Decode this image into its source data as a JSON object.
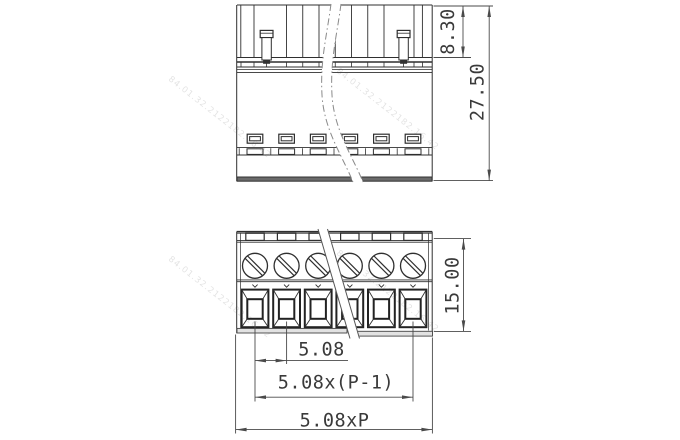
{
  "dims": {
    "d830": {
      "label": "8.30"
    },
    "d2750": {
      "label": "27.50"
    },
    "d1500": {
      "label": "15.00"
    },
    "d508": {
      "label": "5.08"
    },
    "d508p1": {
      "label": "5.08x(P-1)"
    },
    "d508p": {
      "label": "5.08xP"
    }
  },
  "watermark": {
    "text": "84.01.32.2122182.16.42"
  },
  "geometry": {
    "poles_visible": 6,
    "pole_centers_px": [
      255,
      286.6,
      318.2,
      349.8,
      381.4,
      413
    ],
    "pin_centers_px": [
      266.6,
      403.6
    ],
    "rib_xs_px": [
      254,
      286.5,
      302.75,
      319,
      335.25,
      351.5,
      367.75,
      384,
      414
    ],
    "screw_center_y_px": 265.8,
    "screw_radius_px": 12.5
  },
  "colors": {
    "line": "#2f2f2f",
    "dim": "#4a4a4a",
    "base_fill_dark": "#6a6a6a",
    "base_fill_light": "#e2e2e2",
    "break_line": "#8a8a8a"
  }
}
